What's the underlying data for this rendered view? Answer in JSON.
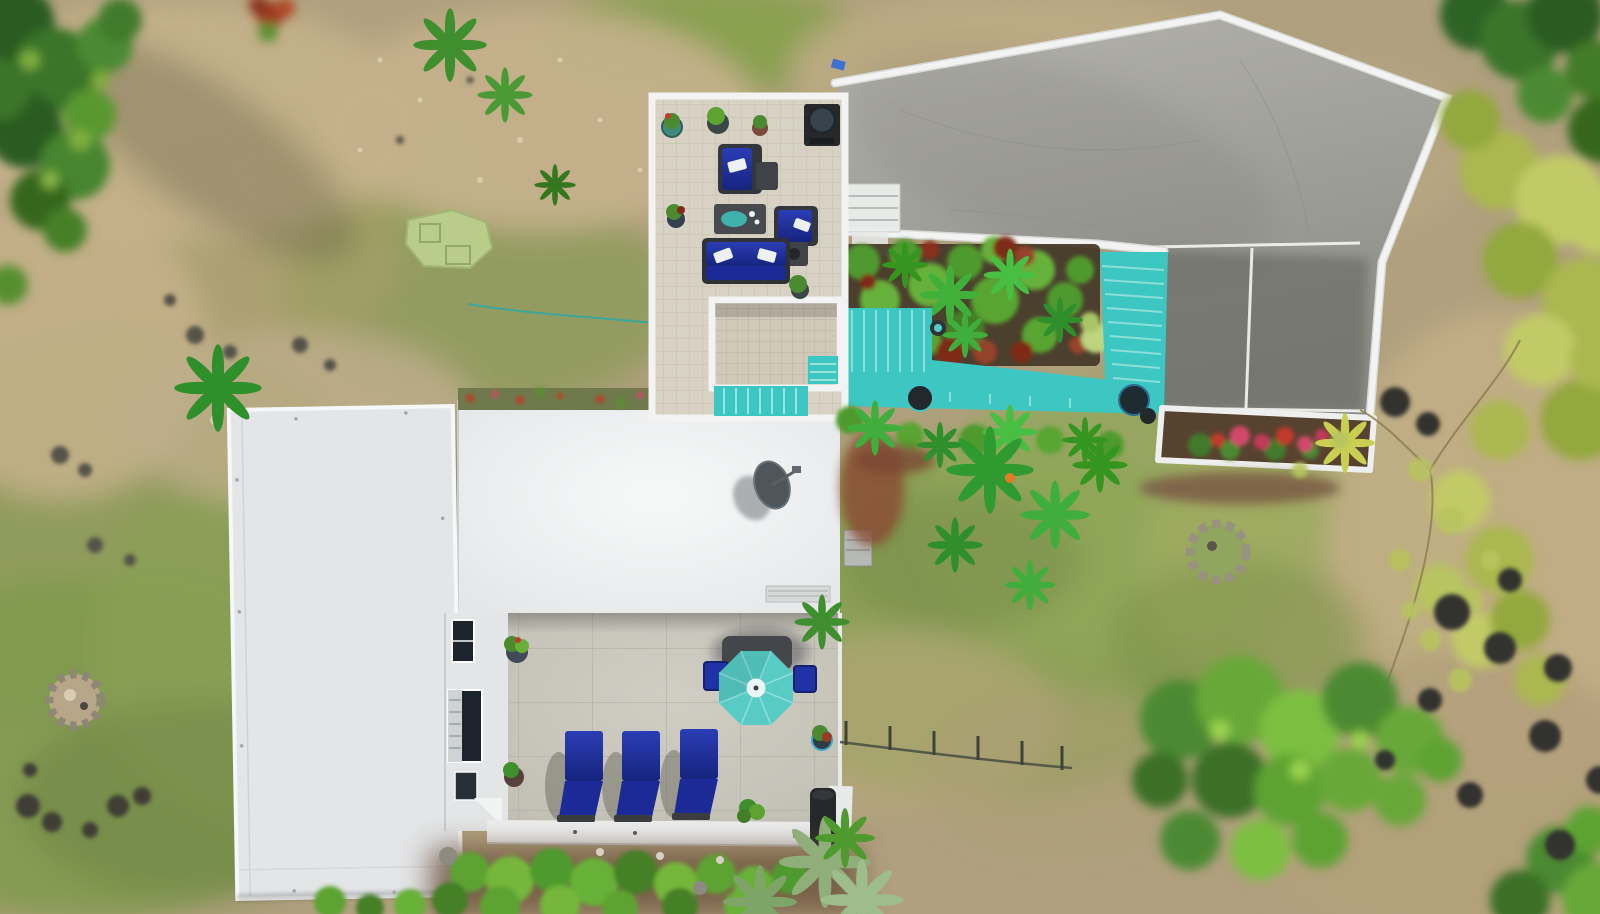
{
  "scene": {
    "type": "aerial-drone-photo",
    "subject": "overhead view of a tropical villa with white flat roofs, tiled roof terrace with blue outdoor furniture, turquoise painted pool deck and stairs, concrete driveway, gardens, lawns and rocky terrain"
  },
  "palette": {
    "terrain_dirt": "#b0a07e",
    "dirt_light": "#c4b18b",
    "grass_olive": "#8a9b55",
    "grass_green": "#7f9a4e",
    "moss_dark": "#6f8445",
    "tree_dark": "#2c5c24",
    "tree_green": "#3a7429",
    "tree_mid": "#4c8a31",
    "tree_bright": "#68b138",
    "tree_lime": "#9cd44f",
    "canopy_yellow": "#aab84f",
    "canopy_yellow_light": "#c1ca66",
    "shrub_green": "#5da332",
    "palm_green": "#3fae3c",
    "palm_silver": "#8fae7a",
    "mulch_red": "#8a4a32",
    "mulch_brown": "#7d5f46",
    "soil_dark": "#423626",
    "rock_dark": "#3a3a33",
    "rock_gray": "#8d8a80",
    "stone_light": "#cfc4a8",
    "concrete_light": "#b3b2ac",
    "concrete_mid": "#8e8e88",
    "concrete_dark": "#6e6f69",
    "patio_gray": "#c9c7bc",
    "tile_beige": "#d8d2c4",
    "tile_line": "#c6bfae",
    "wall_white": "#f2f3f2",
    "roof_white": "#e3e5e7",
    "roof_bright": "#f6f8f8",
    "deck_teal": "#3cc7c2",
    "deck_step": "#9ae4dd",
    "umbrella_teal": "#58cbc5",
    "furniture_blue": "#1d2f9f",
    "furniture_blue_dark": "#16247e",
    "cushion_white": "#eef1f3",
    "frame_dark": "#3a3d40",
    "putting_green": "#b9cc8a",
    "flower_red": "#c13a2c",
    "flower_pink": "#d14a6a",
    "hose_teal": "#2ea8a0",
    "window_dark": "#1d242d"
  },
  "objects": {
    "driveway": {
      "material": "concrete",
      "walls": "white painted retaining walls"
    },
    "pool_deck": {
      "label": "turquoise painted deck and stairs wrapping a tropical garden bed",
      "color": "#3cc7c2"
    },
    "garden_bed": {
      "plants": "fan palms, red cordyline, light green shrub"
    },
    "planter": {
      "flowers": "pink-red bougainvillea and yellow palm"
    },
    "roof_terrace": {
      "sofas": 1,
      "armchairs": 2,
      "coffee_tables": 1,
      "side_tables": 2,
      "grill": 1,
      "planter_pots": 6,
      "cushion_color": "#1d2f9f",
      "pillow_color": "#eef1f3"
    },
    "lounge_chairs": {
      "count": 3,
      "color": "#1d2f9f",
      "positions": [
        [
          565,
          731
        ],
        [
          622,
          731
        ],
        [
          680,
          729
        ]
      ]
    },
    "umbrella": {
      "color": "#58cbc5",
      "shape": "octagon",
      "center": [
        756,
        688
      ]
    },
    "patio": {
      "dining_chairs": 2,
      "planter_pots": 3,
      "trash_bins": 1,
      "material": "concrete slabs"
    },
    "satellite_dish": {
      "count": 1
    },
    "ac_unit": {
      "count": 1
    },
    "putting_green": {
      "color": "#b9cc8a"
    },
    "fence": {
      "posts": [
        [
          846,
          741
        ],
        [
          890,
          746
        ],
        [
          934,
          751
        ],
        [
          978,
          756
        ],
        [
          1022,
          761
        ],
        [
          1062,
          766
        ]
      ]
    }
  }
}
